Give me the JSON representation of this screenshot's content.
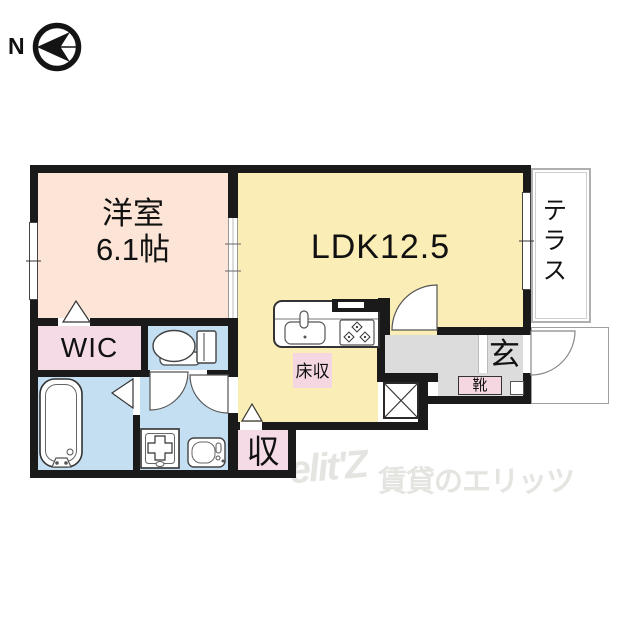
{
  "compass": {
    "north_label": "N"
  },
  "rooms": {
    "western_room": {
      "name": "洋室",
      "size": "6.1帖"
    },
    "ldk": {
      "label": "LDK12.5"
    },
    "terrace": {
      "label": "テラス"
    },
    "wic": {
      "label": "WIC"
    },
    "floor_storage": {
      "label": "床収"
    },
    "storage": {
      "label": "収"
    },
    "entrance": {
      "label": "玄"
    },
    "shoe_cabinet": {
      "label": "靴"
    }
  },
  "fixtures": [
    "kitchen-sink",
    "kitchen-stove",
    "toilet",
    "bathtub",
    "washing-machine-pan",
    "washbasin",
    "refrigerator-space"
  ],
  "watermark": {
    "logo": "elit'Z",
    "text": "賃貸のエリッツ"
  },
  "colors": {
    "western_room": "#fce4d6",
    "ldk": "#faedb5",
    "closet_pink": "#f5dbe6",
    "wet_area_blue": "#c4def2",
    "entrance_gray": "#dcdcdc",
    "wall": "#1a1a1a",
    "watermark_gray": "#e4e4e1"
  }
}
